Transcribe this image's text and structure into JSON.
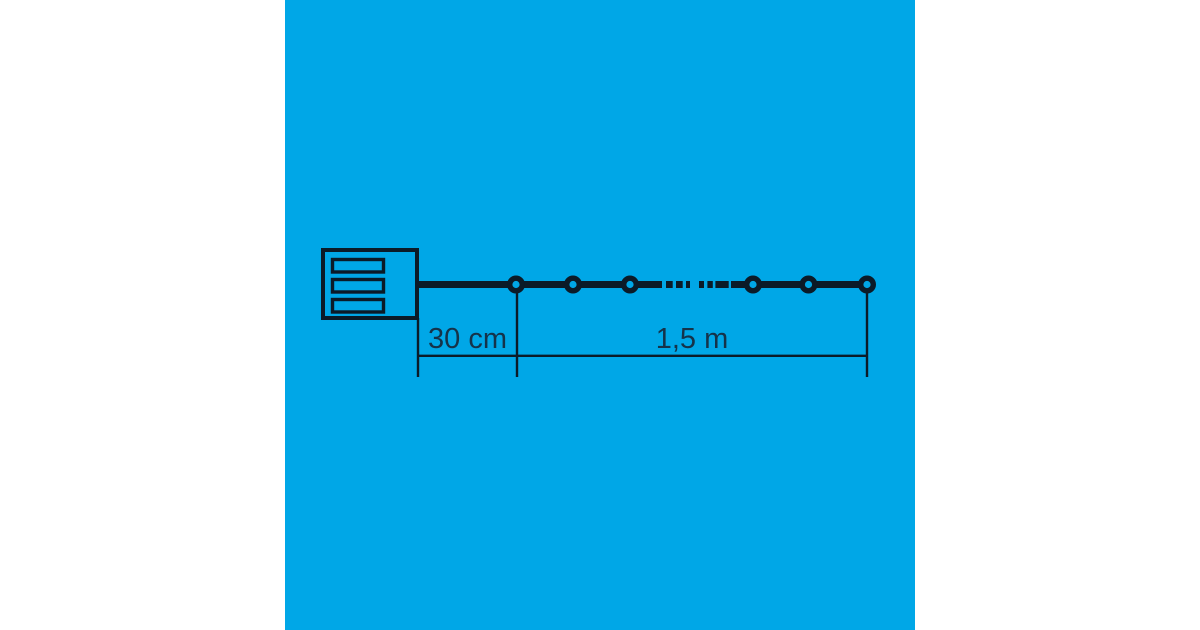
{
  "colors": {
    "pageBg": "#ffffff",
    "panelBg": "#00a7e7",
    "ink": "#0b1b28",
    "label": "#15334a"
  },
  "diagram": {
    "kind": "usb-light-chain-dimension-diagram",
    "visible_led_count": 6,
    "labels": {
      "lead_length": "30 cm",
      "chain_length": "1,5 m"
    }
  }
}
